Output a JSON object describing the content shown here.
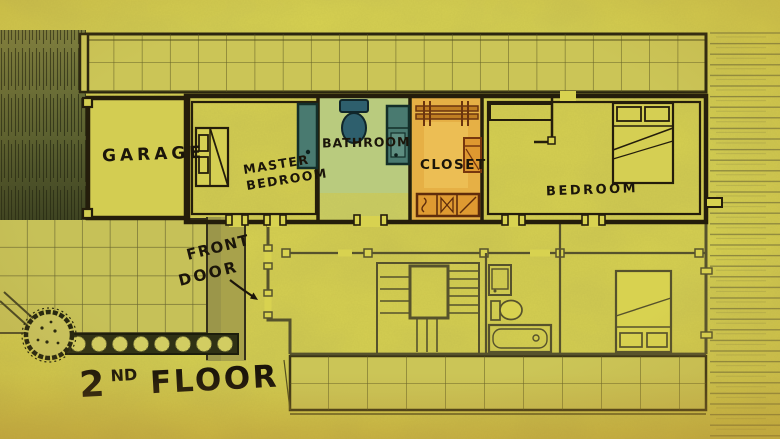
{
  "image_type": "hand-drawn architectural floor plan sketch on yellow paper",
  "floor_label": {
    "number": "2",
    "ordinal": "ND",
    "word": "FLOOR"
  },
  "rooms": {
    "garage": {
      "label": "GARAGE"
    },
    "master_bedroom": {
      "line1": "MASTER",
      "line2": "BEDROOM"
    },
    "bathroom": {
      "label": "BATHROOM"
    },
    "closet": {
      "label": "CLOSET"
    },
    "bedroom": {
      "label": "BEDROOM"
    }
  },
  "annotations": {
    "front_door": {
      "line1": "FRONT",
      "line2": "DOOR"
    }
  },
  "features": {
    "upper_floor": [
      "master-bed",
      "bathroom-toilet",
      "bathroom-shower-door",
      "bathroom-sink",
      "closet-hanger-rod",
      "closet-cabinet",
      "closet-dresser",
      "bedroom-bed",
      "bedroom-closet"
    ],
    "lower_floor": [
      "front-walkway",
      "staircase",
      "sink",
      "toilet",
      "bathtub",
      "bed"
    ],
    "yard": [
      "hedge",
      "paved-patio",
      "flower-bed",
      "bush",
      "garden-path",
      "roof-top",
      "roof-bottom",
      "side-yard"
    ]
  },
  "colors": {
    "paper": "#d8d250",
    "patio": "#c6c158",
    "roof": "#cbc557",
    "ink": "#241d0b",
    "faint_ink": "#56522c",
    "foliage": "#5f652f",
    "bathroom_green": "#b9cb7e",
    "fixture_teal": "#497a70",
    "toilet_teal": "#2e5f6d",
    "closet_orange": "#e6b045",
    "wood_orange": "#df9a31",
    "label_ink": "#1b150a"
  }
}
